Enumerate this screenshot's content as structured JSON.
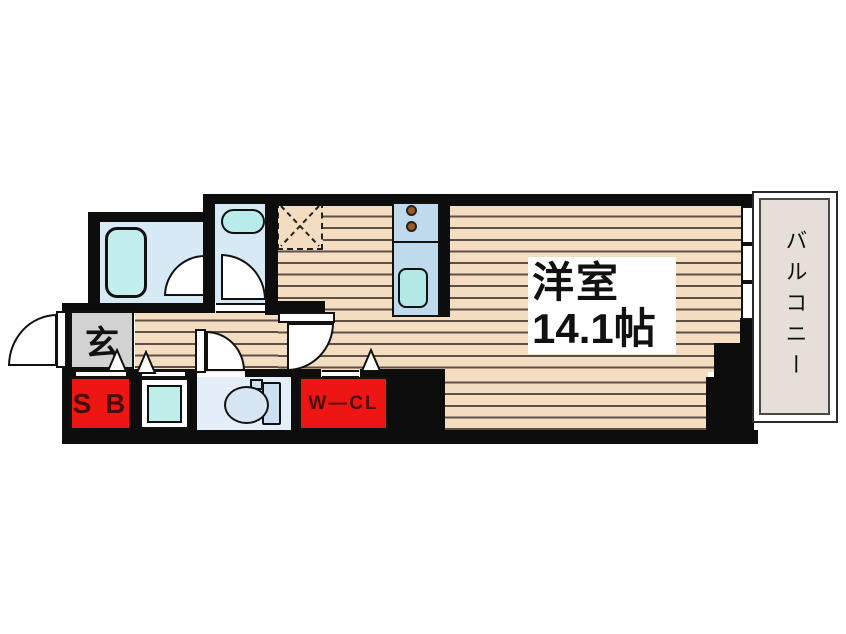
{
  "floor_plan": {
    "labels": {
      "main_room_name": "洋室",
      "main_room_size": "14.1帖",
      "balcony": "バルコニー",
      "entrance": "玄",
      "shoe_box": "S B",
      "walk_in_closet": "W—CL"
    },
    "colors": {
      "wall": "#0d0d0d",
      "wood_floor": "#f5ddc1",
      "wood_stripe": "#5d5046",
      "wet_room_floor": "#d8e9f6",
      "toilet_floor": "#e3eef8",
      "fixture_cyan": "#bfeeea",
      "kitchen_counter_blue": "#bfdaec",
      "closet_red": "#ee1515",
      "closet_text": "#4a0b0b",
      "entrance_gray": "#d2d2d2",
      "balcony_beige": "#e5dfd7"
    },
    "icons": [
      "bathtub-icon",
      "washbasin-icon",
      "toilet-icon",
      "washing-machine-pan-icon",
      "stove-burner-icon",
      "kitchen-sink-icon",
      "refrigerator-space-icon",
      "door-swing-icon",
      "step-triangle-icon",
      "window-icon"
    ]
  }
}
